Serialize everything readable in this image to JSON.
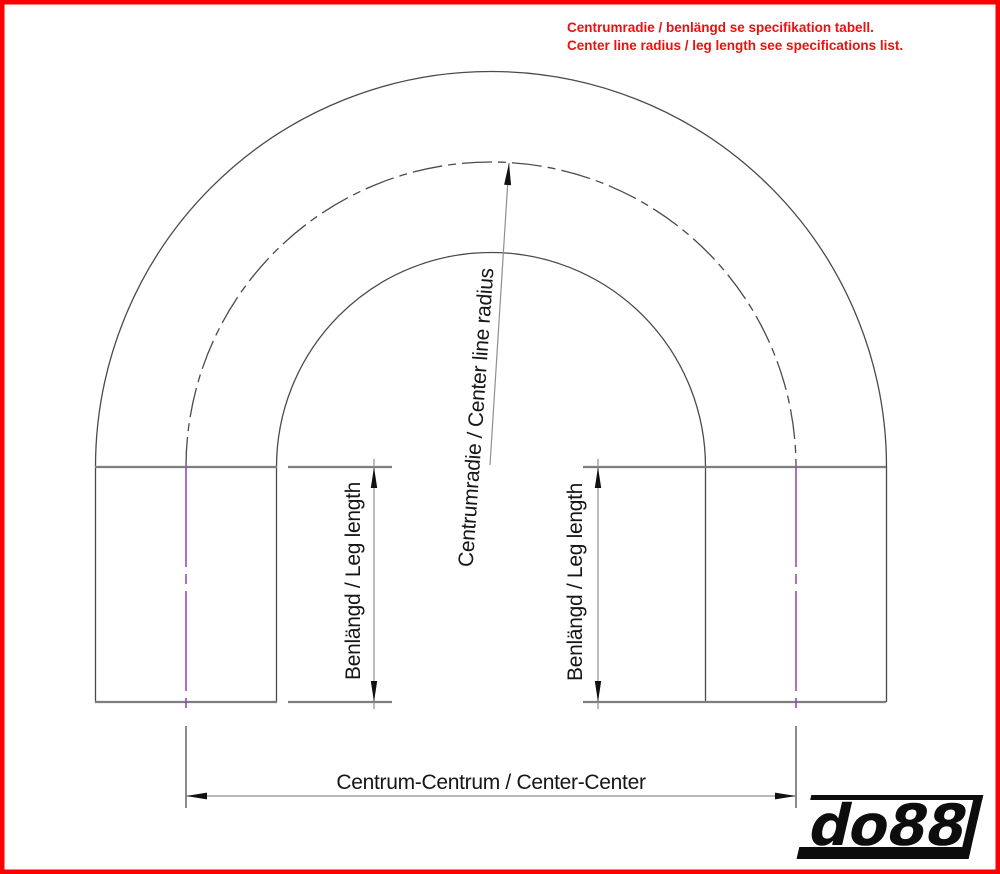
{
  "page": {
    "border_color": "#fe0000",
    "background": "#ffffff"
  },
  "header": {
    "note_line1": "Centrumradie / benlängd se specifikation tabell.",
    "note_line2": "Center line radius / leg length see specifications list.",
    "note_color": "#ed1010"
  },
  "diagram": {
    "type": "180-degree-bend-technical-drawing",
    "labels": {
      "center_radius": "Centrumradie / Center line radius",
      "leg_length_left": "Benlängd / Leg length",
      "leg_length_right": "Benlängd / Leg length",
      "center_center": "Centrum-Centrum / Center-Center"
    },
    "colors": {
      "outline": "#4a4a4a",
      "tangent_line": "#7e7e7e",
      "dimension_line": "#8f8f8f",
      "arrowhead": "#111111",
      "leg_centerline": "#9040b8",
      "text": "#161616"
    }
  },
  "logo": {
    "text": "do88",
    "color": "#0d0d0d"
  }
}
